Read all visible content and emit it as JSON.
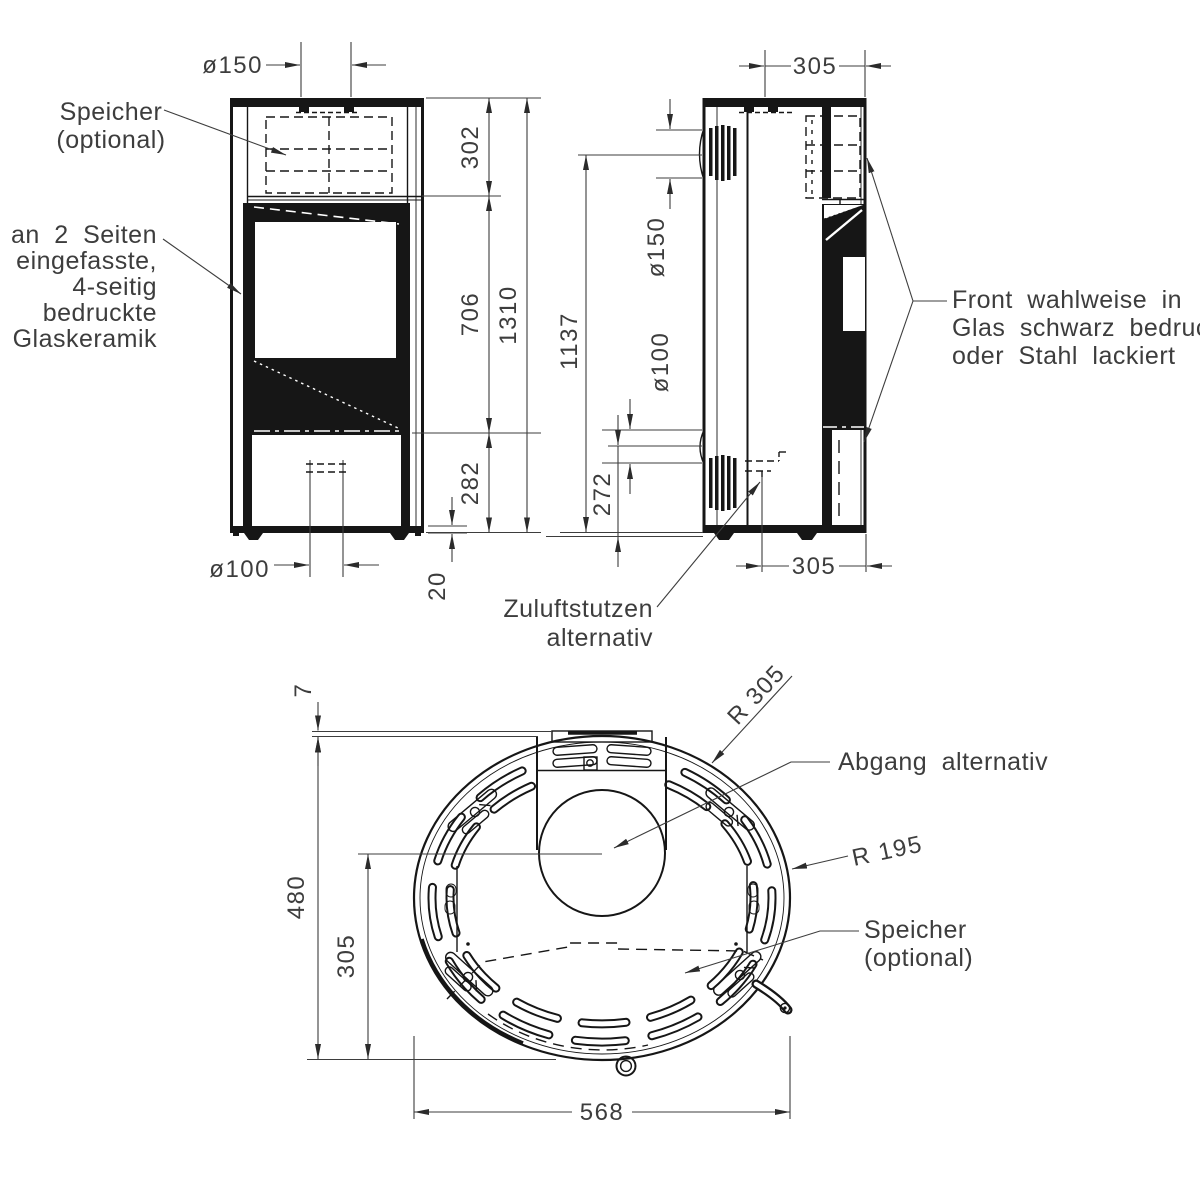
{
  "front_view": {
    "dims": {
      "flue_dia": "ø150",
      "storage_height": "302",
      "glass_height": "706",
      "total_height": "1310",
      "base_height": "282",
      "inlet_dia": "ø100",
      "plinth_height": "20"
    },
    "labels": {
      "speicher": [
        "Speicher",
        "(optional)"
      ],
      "glass": [
        "an 2 Seiten",
        "eingefasste,",
        "4-seitig",
        "bedruckte",
        "Glaskeramik"
      ]
    }
  },
  "side_view": {
    "dims": {
      "depth_top": "305",
      "flue_dia": "ø150",
      "flue_center_height": "1137",
      "inlet_dia": "ø100",
      "inlet_center_height": "272",
      "depth_bottom": "305"
    },
    "labels": {
      "front_panel": [
        "Front wahlweise in",
        "Glas schwarz bedruckt",
        "oder Stahl lackiert"
      ],
      "zuluft": [
        "Zuluftstutzen",
        "alternativ"
      ]
    }
  },
  "top_view": {
    "dims": {
      "plate_offset": "7",
      "radius_back": "R 305",
      "radius_side": "R 195",
      "depth_total": "480",
      "flue_center_offset": "305",
      "width": "568"
    },
    "labels": {
      "abgang": "Abgang alternativ",
      "speicher": [
        "Speicher",
        "(optional)"
      ]
    }
  }
}
